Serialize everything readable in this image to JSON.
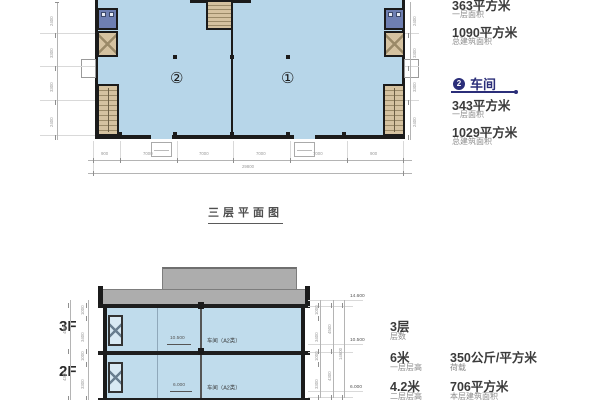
{
  "plan": {
    "title": "三层平面图",
    "unit_left": "②",
    "unit_right": "①",
    "dims_bottom": [
      "900",
      "7000",
      "7000",
      "7000",
      "7000",
      "900"
    ],
    "dims_bottom_total": "29800",
    "dims_left": [
      "2400",
      "3300",
      "3300",
      "2400"
    ],
    "dims_right": [
      "2400",
      "3300",
      "3300",
      "2400"
    ]
  },
  "info_panel": {
    "unit1": {
      "area_value": "363平方米",
      "area_label": "一层面积",
      "total_value": "1090平方米",
      "total_label": "总建筑面积"
    },
    "unit2": {
      "badge": "2",
      "title": "车间",
      "area_value": "343平方米",
      "area_label": "一层面积",
      "total_value": "1029平方米",
      "total_label": "总建筑面积"
    }
  },
  "section": {
    "floor3_label": "3F",
    "floor2_label": "2F",
    "room3_label": "车间（A2类）",
    "room2_label": "车间（A2类）",
    "elev_3f": "10.500",
    "elev_2f": "6.000",
    "elev_roof_right": "14.600",
    "elev_3f_right": "10.500",
    "elev_2f_right": "6.000",
    "dims_left_a": [
      "1000",
      "3400",
      "1000",
      "3300"
    ],
    "dims_left_b": [
      "4500",
      "4300"
    ],
    "dims_right_a": [
      "1000",
      "3400",
      "1000",
      "3300"
    ],
    "dims_right_b": [
      "4500",
      "4300"
    ],
    "dims_right_total": "14600"
  },
  "specs": {
    "floors_value": "3层",
    "floors_label": "层数",
    "h1_value": "6米",
    "h1_label": "一层层高",
    "load_value": "350公斤/平方米",
    "load_label": "荷载",
    "h2_value": "4.2米",
    "h2_label": "二层层高",
    "area_value": "706平方米",
    "area_label": "本层建筑面积"
  },
  "colors": {
    "accent_navy": "#2b2e79",
    "plan_fill": "#b7d6e9",
    "section_fill": "#c0dcec",
    "stair_tan": "#d5c2a0",
    "toilet_blue": "#6e7fb2",
    "roof_gray": "#adadad"
  }
}
